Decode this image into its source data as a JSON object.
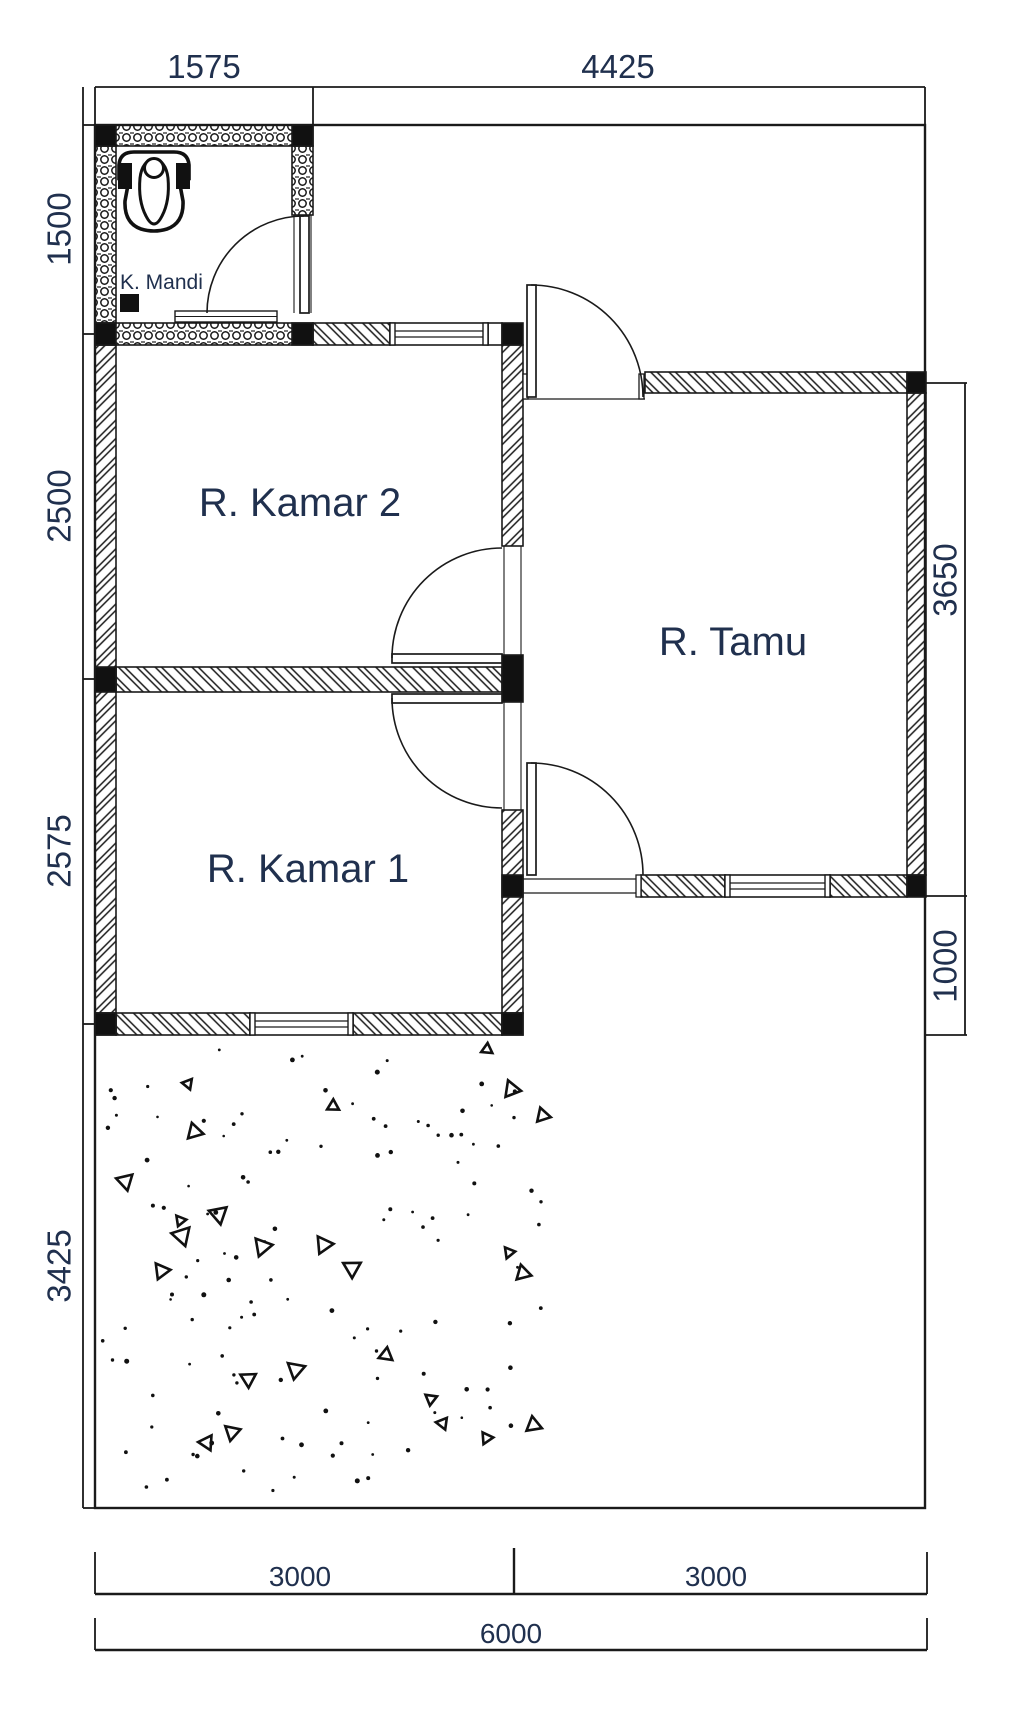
{
  "plan": {
    "rooms": {
      "bathroom": "K. Mandi",
      "bedroom2": "R. Kamar 2",
      "bedroom1": "R. Kamar 1",
      "living": "R. Tamu"
    },
    "dims": {
      "top": [
        "1575",
        "4425"
      ],
      "left": [
        "1500",
        "2500",
        "2575",
        "3425"
      ],
      "right": [
        "3650",
        "1000"
      ],
      "bottom": [
        "3000",
        "3000"
      ],
      "bottom_total": "6000"
    },
    "colors": {
      "line": "#1a1a1a",
      "text": "#20304e",
      "paper": "#ffffff"
    }
  }
}
